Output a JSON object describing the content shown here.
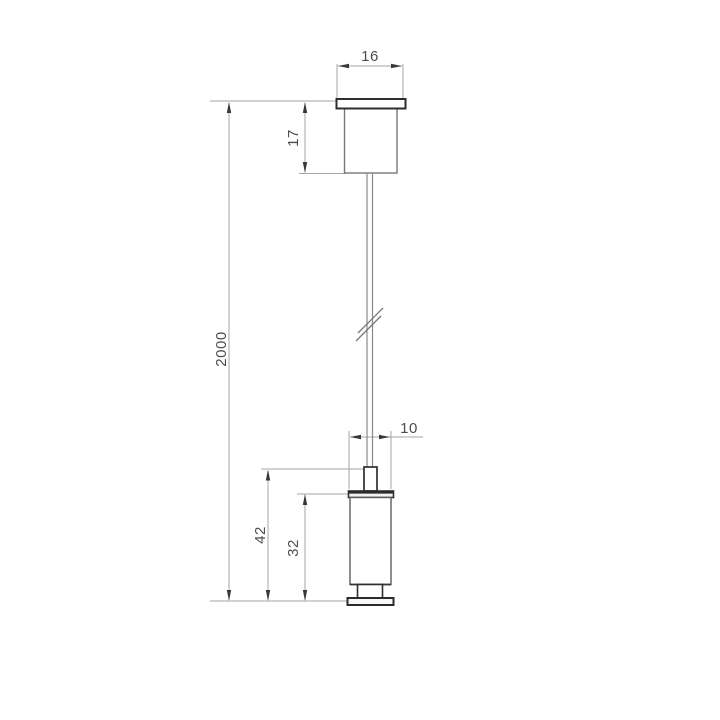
{
  "drawing": {
    "kind": "suspension-kit-dimension-drawing",
    "dims": {
      "flange_width": "16",
      "canopy_height": "17",
      "cable_length": "2000",
      "gripper_diameter": "10",
      "gripper_total_height": "42",
      "gripper_body_height": "32"
    },
    "colors": {
      "background": "#ffffff",
      "part_outline_dark": "#2e2e2e",
      "part_outline_gray": "#6f6f6f",
      "cable": "#8a8a8a",
      "dimension_line": "#a5a5a5",
      "arrowhead": "#383838",
      "label_text": "#4d4d4d"
    }
  }
}
